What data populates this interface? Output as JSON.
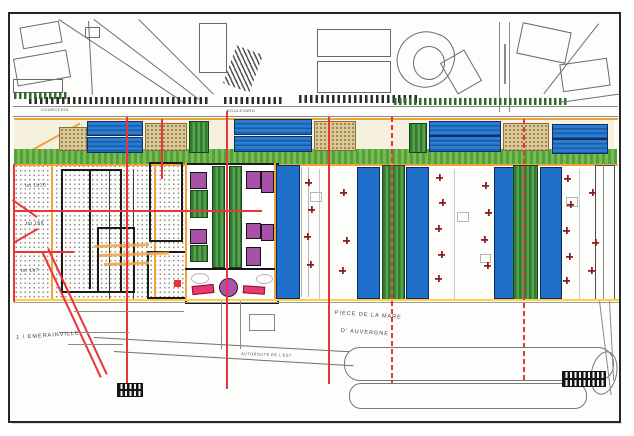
{
  "document": {
    "type": "scanned urban development site plan",
    "sheet_background": "#ffffff",
    "frame_color": "#262626"
  },
  "streets": {
    "courcerin": "COURCERIN",
    "boulevard": "BOULEVARD",
    "autoroute": "AUTOROUTE DE L'EST",
    "piece_de_la_mare": "PIECE DE LA MARE",
    "d_auvergne": "D' AUVERGNE"
  },
  "places": {
    "commune_prefix": "1 /",
    "commune": "EMERAINVILLE"
  },
  "lots": {
    "lot_1": "lot 1b10",
    "lot_2": "lot 1b8",
    "lot_3": "lot 1b7"
  },
  "legend_colors": {
    "housing_roof_blue": "#2a7cd1",
    "warehouse_blue": "#1f6fca",
    "activity_purple": "#a751a7",
    "green_space": "#2f7d33",
    "band_green": "#55a038",
    "alignment_red": "#e8353a",
    "tree_dark_red": "#8e1f1f",
    "boundary_orange": "#f2a23a",
    "boundary_yellow": "#ffd23c",
    "existing_building_beige": "#dcc894"
  },
  "symbols": {
    "tree": "tree-cross-symbol",
    "roundabout": "roundabout-circle"
  }
}
